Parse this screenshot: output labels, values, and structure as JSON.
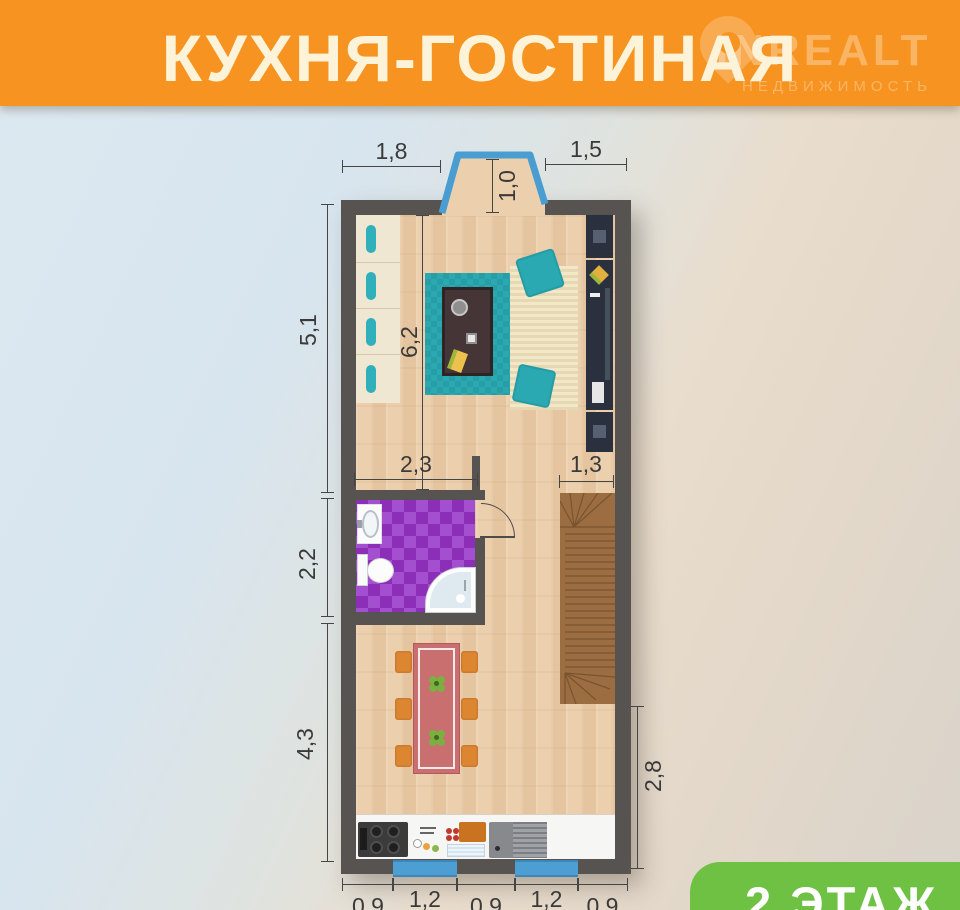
{
  "header": {
    "title": "КУХНЯ-ГОСТИНАЯ",
    "watermark": {
      "brand": "INREALT",
      "tagline": "НЕДВИЖИМОСТЬ"
    }
  },
  "floor_badge": {
    "label": "2 ЭТАЖ"
  },
  "dimensions": {
    "bay_left": "1,8",
    "bay_right": "1,5",
    "bay_depth": "1,0",
    "living_left": "5,1",
    "living_span": "6,2",
    "bath_left": "2,2",
    "dining_left": "4,3",
    "bath_width": "2,3",
    "stairs_width": "1,3",
    "lower_right": "2,8",
    "bottom_segments": [
      "0,9",
      "1,2",
      "0,9",
      "1,2",
      "0,9"
    ]
  },
  "colors": {
    "banner_orange": "#F79421",
    "badge_green": "#6FC143",
    "wall_gray": "#575350",
    "floor_tan": "#ECD0AE",
    "accent_teal": "#2AA9B2",
    "bathroom_purple": "#9C3FC6",
    "stairs_brown": "#9B6D41",
    "window_blue": "#4D9ED2",
    "dining_table_rose": "#C96F6F",
    "chair_orange": "#DD8631"
  }
}
